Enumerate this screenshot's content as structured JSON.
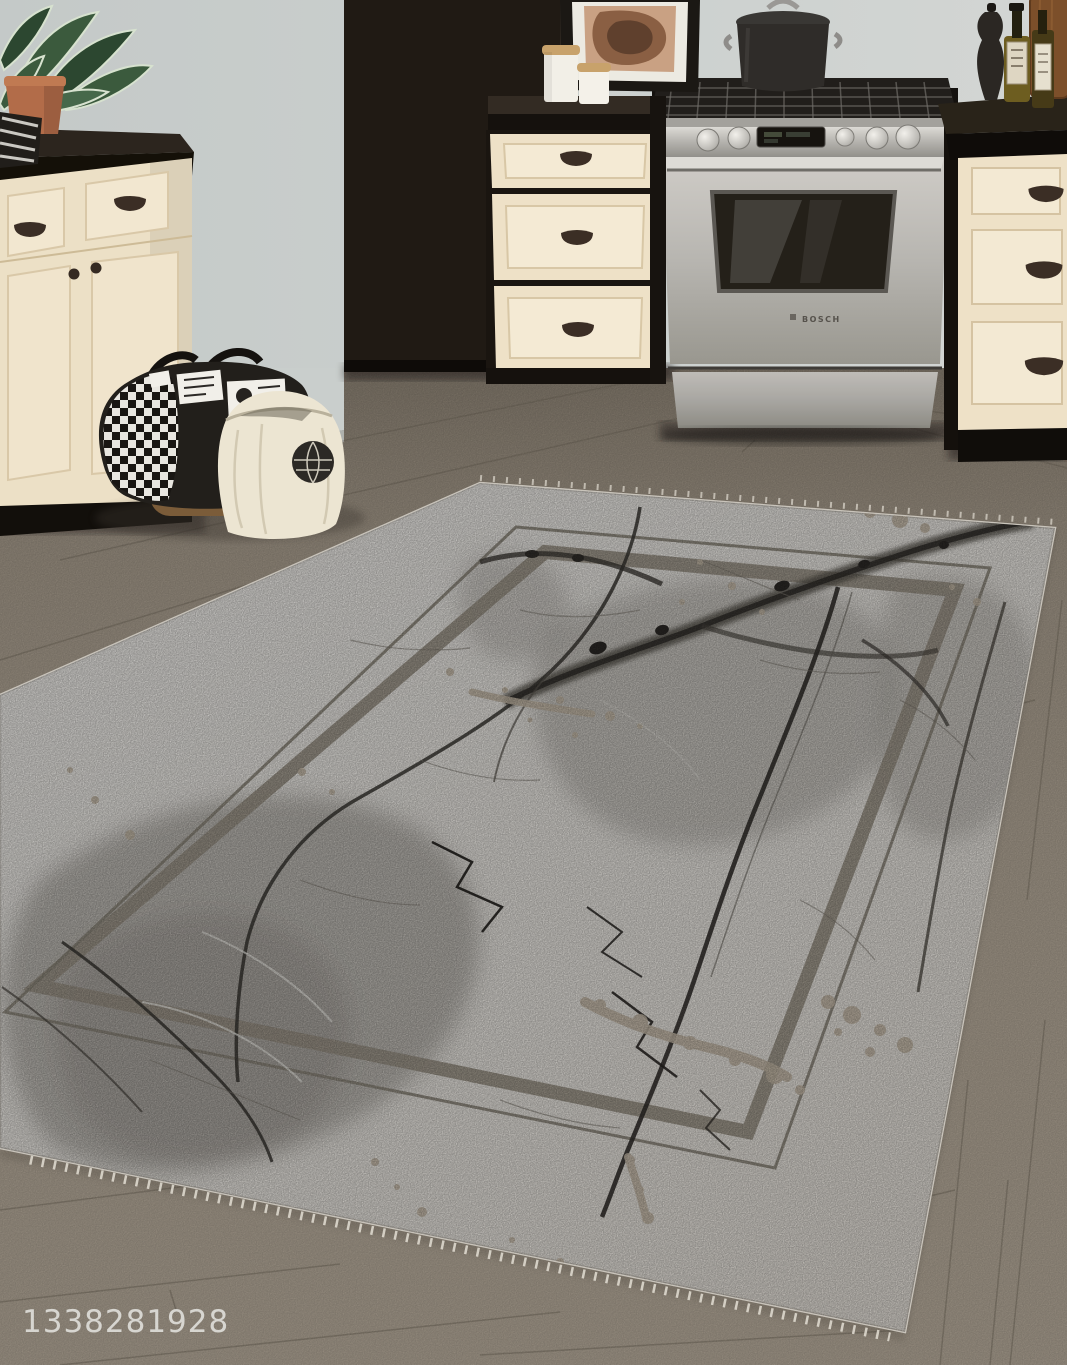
{
  "meta": {
    "description": "Photograph of a kitchen with cream shaker cabinets, a stainless gas range, and a large grey marble-pattern area rug with double-line border on a taupe wood plank floor",
    "width_px": 1067,
    "height_px": 1365
  },
  "watermark": {
    "text": "1338281928",
    "color": "#e9e9e6"
  },
  "stove": {
    "brand_label": "BOSCH"
  },
  "objects": {
    "labels": [
      "potted plant",
      "framed abstract art",
      "ceramic canisters",
      "black stock pot",
      "stainless gas range",
      "olive oil bottles",
      "pepper grinder",
      "wood cutting board",
      "black-and-white print tote bag",
      "cream canvas tote bag",
      "wicker basket",
      "marble-pattern area rug",
      "wood plank floor",
      "cream shaker cabinets",
      "dark countertop"
    ]
  },
  "palette": {
    "wall": "#c8cdcb",
    "counter_top": "#2c251e",
    "counter_front": "#141008",
    "cabinet_cream": "#eee1c7",
    "cabinet_dark": "#261f18",
    "handle": "#3b2e25",
    "stainless": "#c2c0bb",
    "oven_window": "#242019",
    "floor": "#9c9284",
    "floor_seam": "#6f675a",
    "rug_base": "#eeebe5",
    "rug_cloud": "#b4b0aa",
    "rug_border_band": "#9e978a",
    "rug_border_line": "#8f8a7d",
    "rug_vein": "#3a3733",
    "rug_splatter": "#c8bcaa",
    "fringe": "#e3ded4",
    "pot": "#2f2c29",
    "plant": "#3b5a3d",
    "terracotta": "#b26c49",
    "bag_black": "#221f1b",
    "bag_cream": "#ece5d2",
    "basket": "#7b5c39"
  }
}
